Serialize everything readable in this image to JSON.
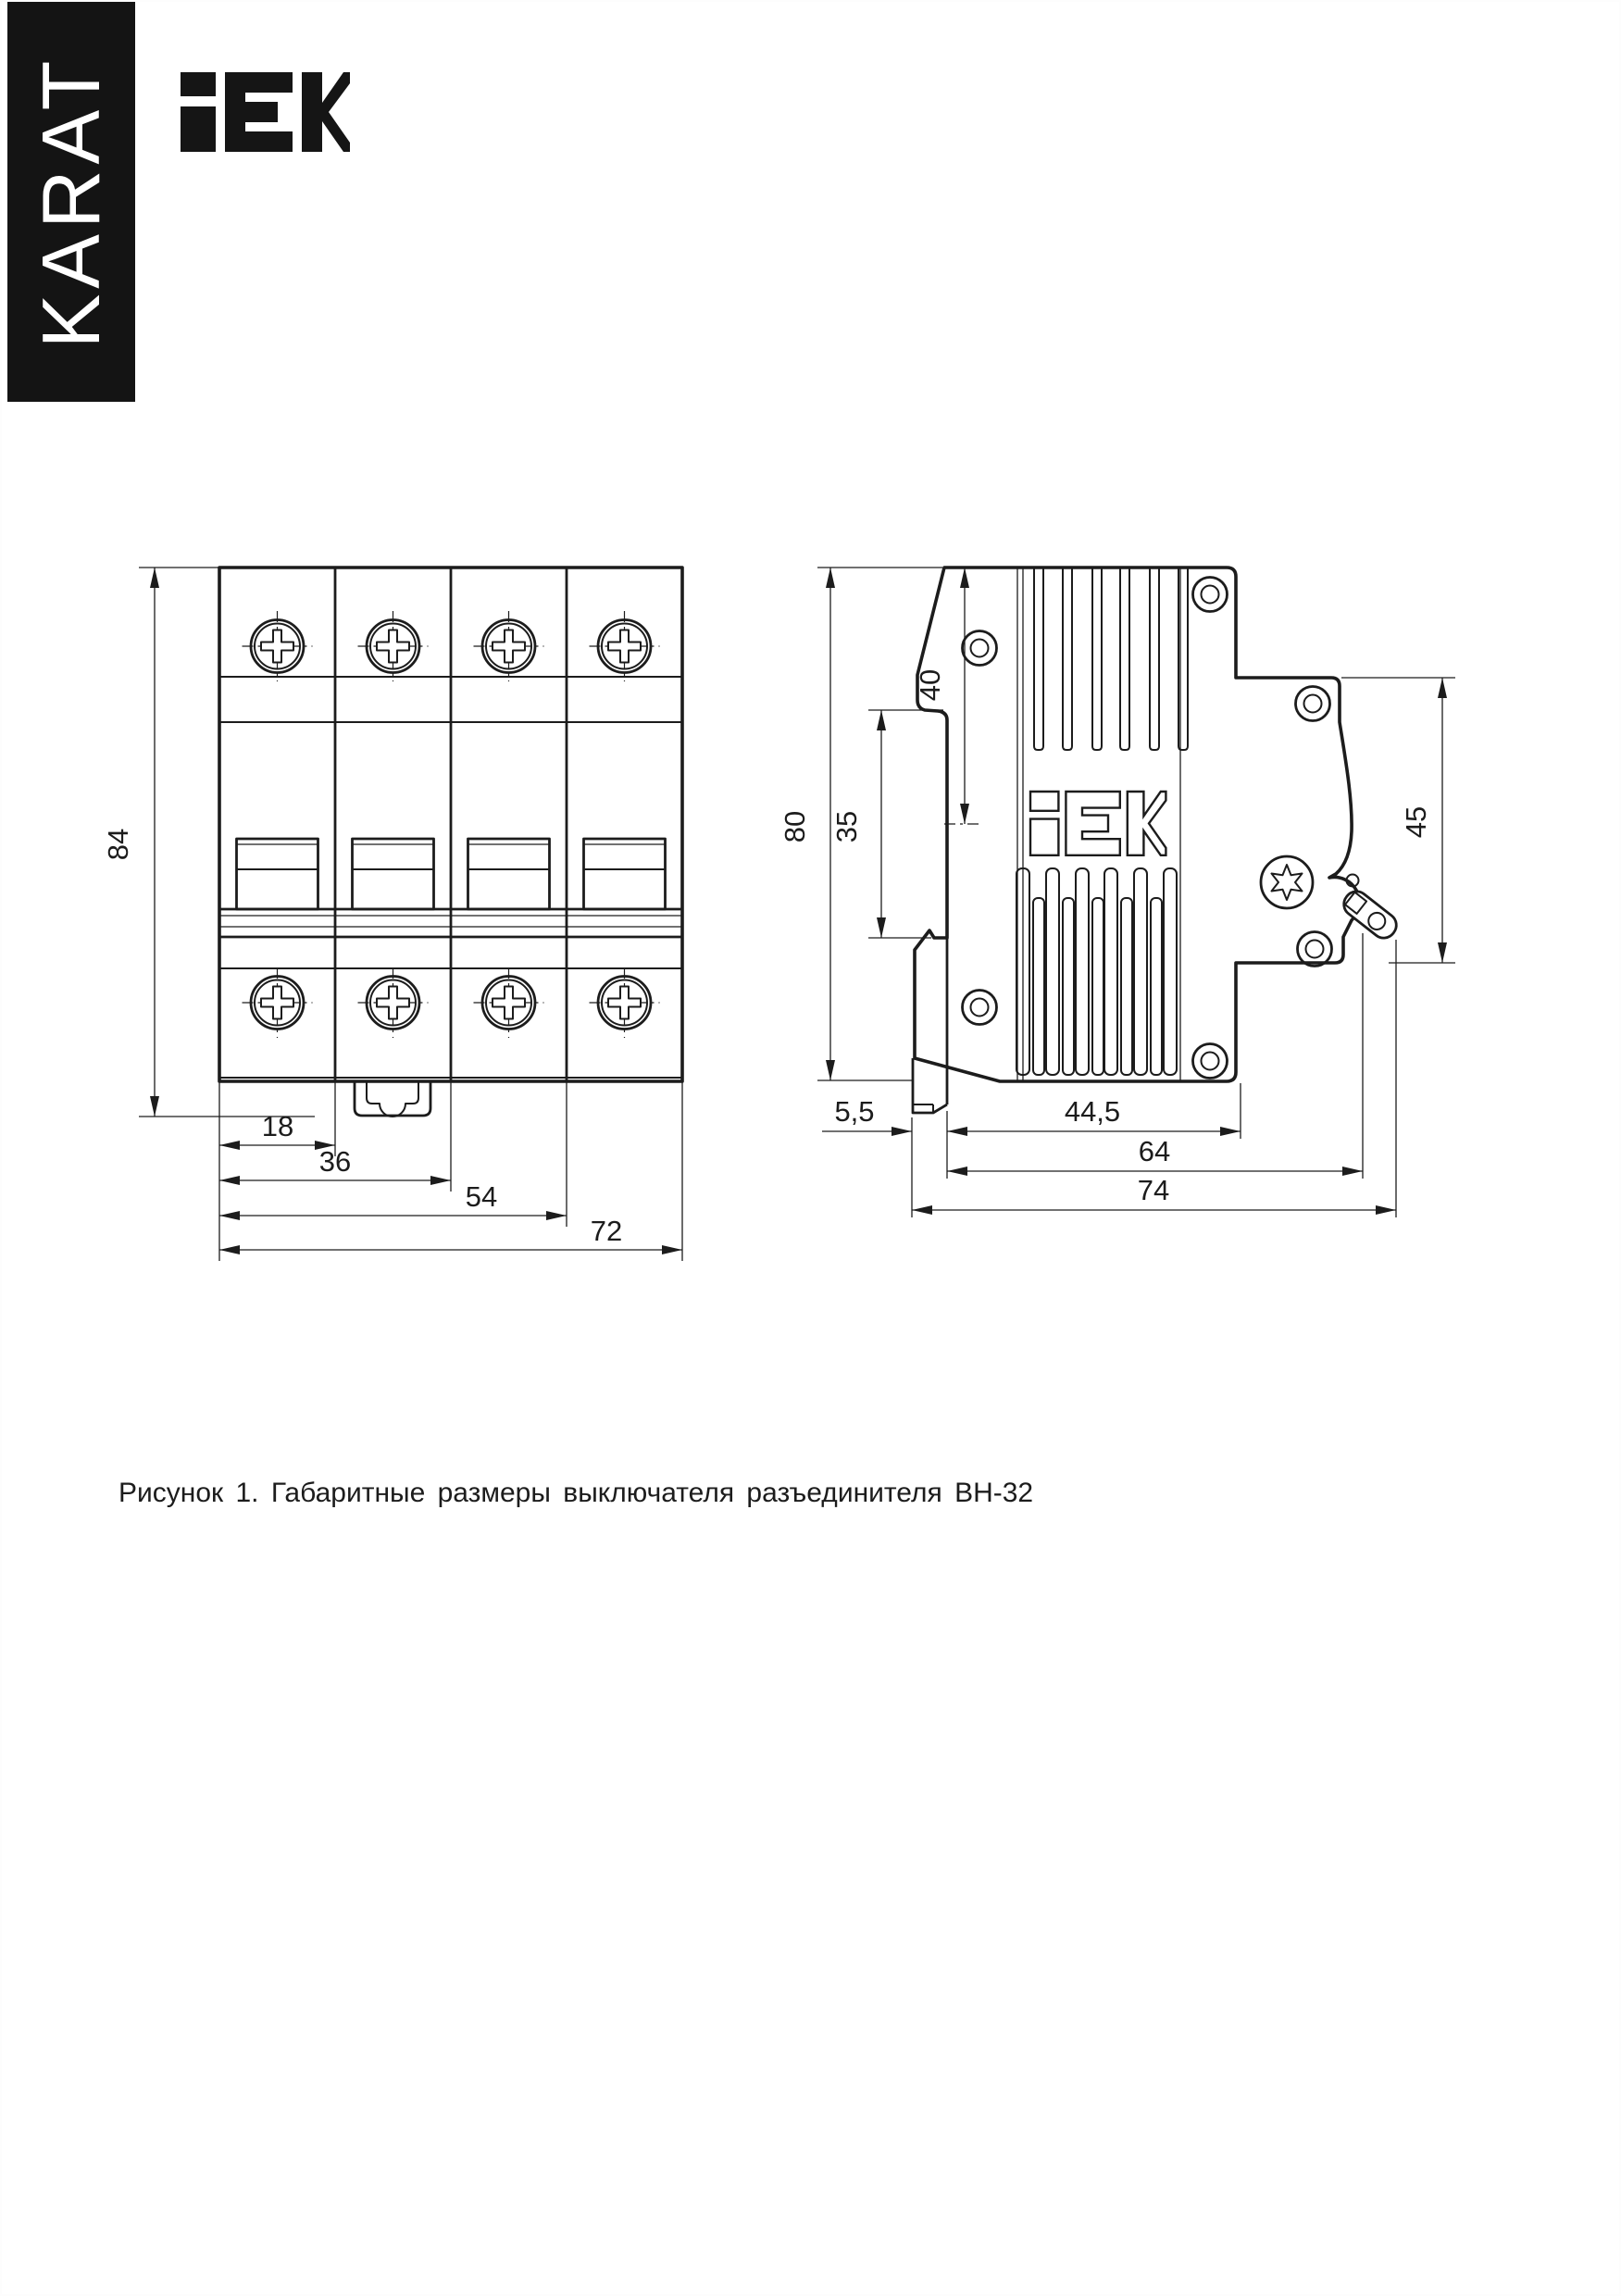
{
  "page": {
    "background": "#ffffff",
    "ink": "#1c1c1c",
    "border_color": "#b5b5b5"
  },
  "brand": {
    "banner_text": "KARAT",
    "banner_bg": "#141414",
    "banner_fg": "#ffffff",
    "logo_text": "iEK"
  },
  "figure": {
    "caption": "Рисунок 1. Габаритные размеры выключателя разъединителя ВН-32"
  },
  "front_view": {
    "title": "front view of 4-pole switch disconnector",
    "dimensions": {
      "height": "84",
      "module_width": "18",
      "two_modules": "36",
      "three_modules": "54",
      "total_width": "72"
    }
  },
  "side_view": {
    "title": "side view of switch disconnector",
    "dimensions": {
      "height": "80",
      "din_rail": "35",
      "top_to_rail_center": "40",
      "front_section_height": "45",
      "clip_protrusion": "5,5",
      "body_depth": "44,5",
      "depth_with_front": "64",
      "total_depth": "74"
    }
  }
}
